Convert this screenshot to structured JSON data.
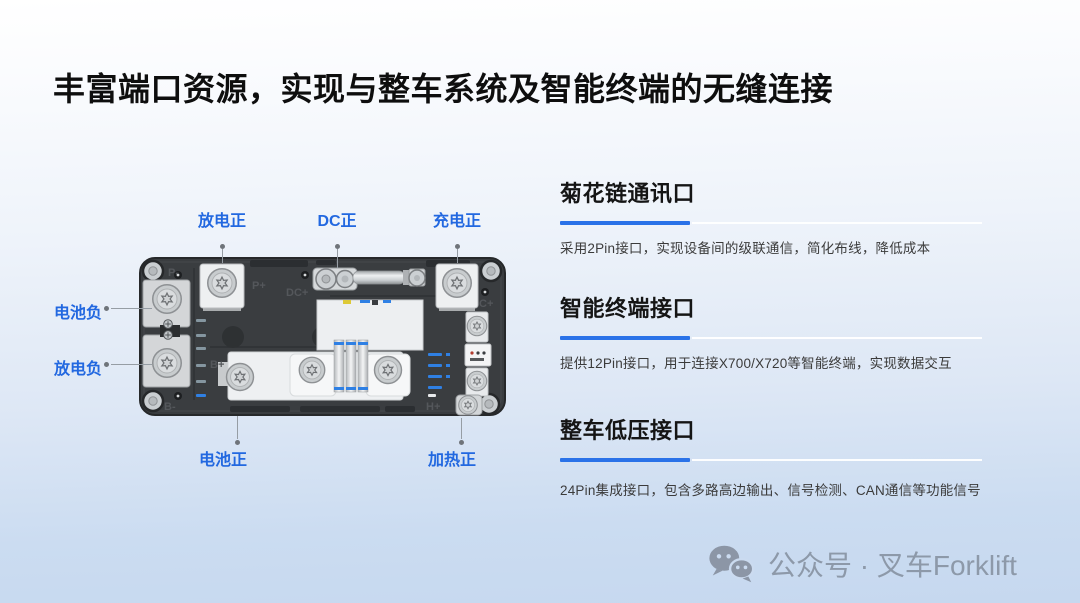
{
  "title": "丰富端口资源，实现与整车系统及智能终端的无缝连接",
  "device": {
    "description": "battery-power-distribution-unit-top-view",
    "callouts": {
      "discharge_pos": "放电正",
      "dc_pos": "DC正",
      "charge_pos": "充电正",
      "battery_neg": "电池负",
      "discharge_neg": "放电负",
      "battery_pos": "电池正",
      "heating_pos": "加热正"
    },
    "engravings": [
      "P-",
      "P+",
      "DC+",
      "C+",
      "B+",
      "B-",
      "H+"
    ]
  },
  "sections": [
    {
      "heading": "菊花链通讯口",
      "body": "采用2Pin接口，实现设备间的级联通信，简化布线，降低成本"
    },
    {
      "heading": "智能终端接口",
      "body": "提供12Pin接口，用于连接X700/X720等智能终端，实现数据交互"
    },
    {
      "heading": "整车低压接口",
      "body": "24Pin集成接口，包含多路高边输出、信号检测、CAN通信等功能信号"
    }
  ],
  "footer": {
    "account_label": "公众号 · 叉车Forklift"
  },
  "colors": {
    "callout_blue": "#2268e0",
    "underline_blue": "#2a72e8",
    "pin_blue": "#2f80e4",
    "background_bottom": "#c6d8ef",
    "footer_gray": "#8d99a9"
  }
}
